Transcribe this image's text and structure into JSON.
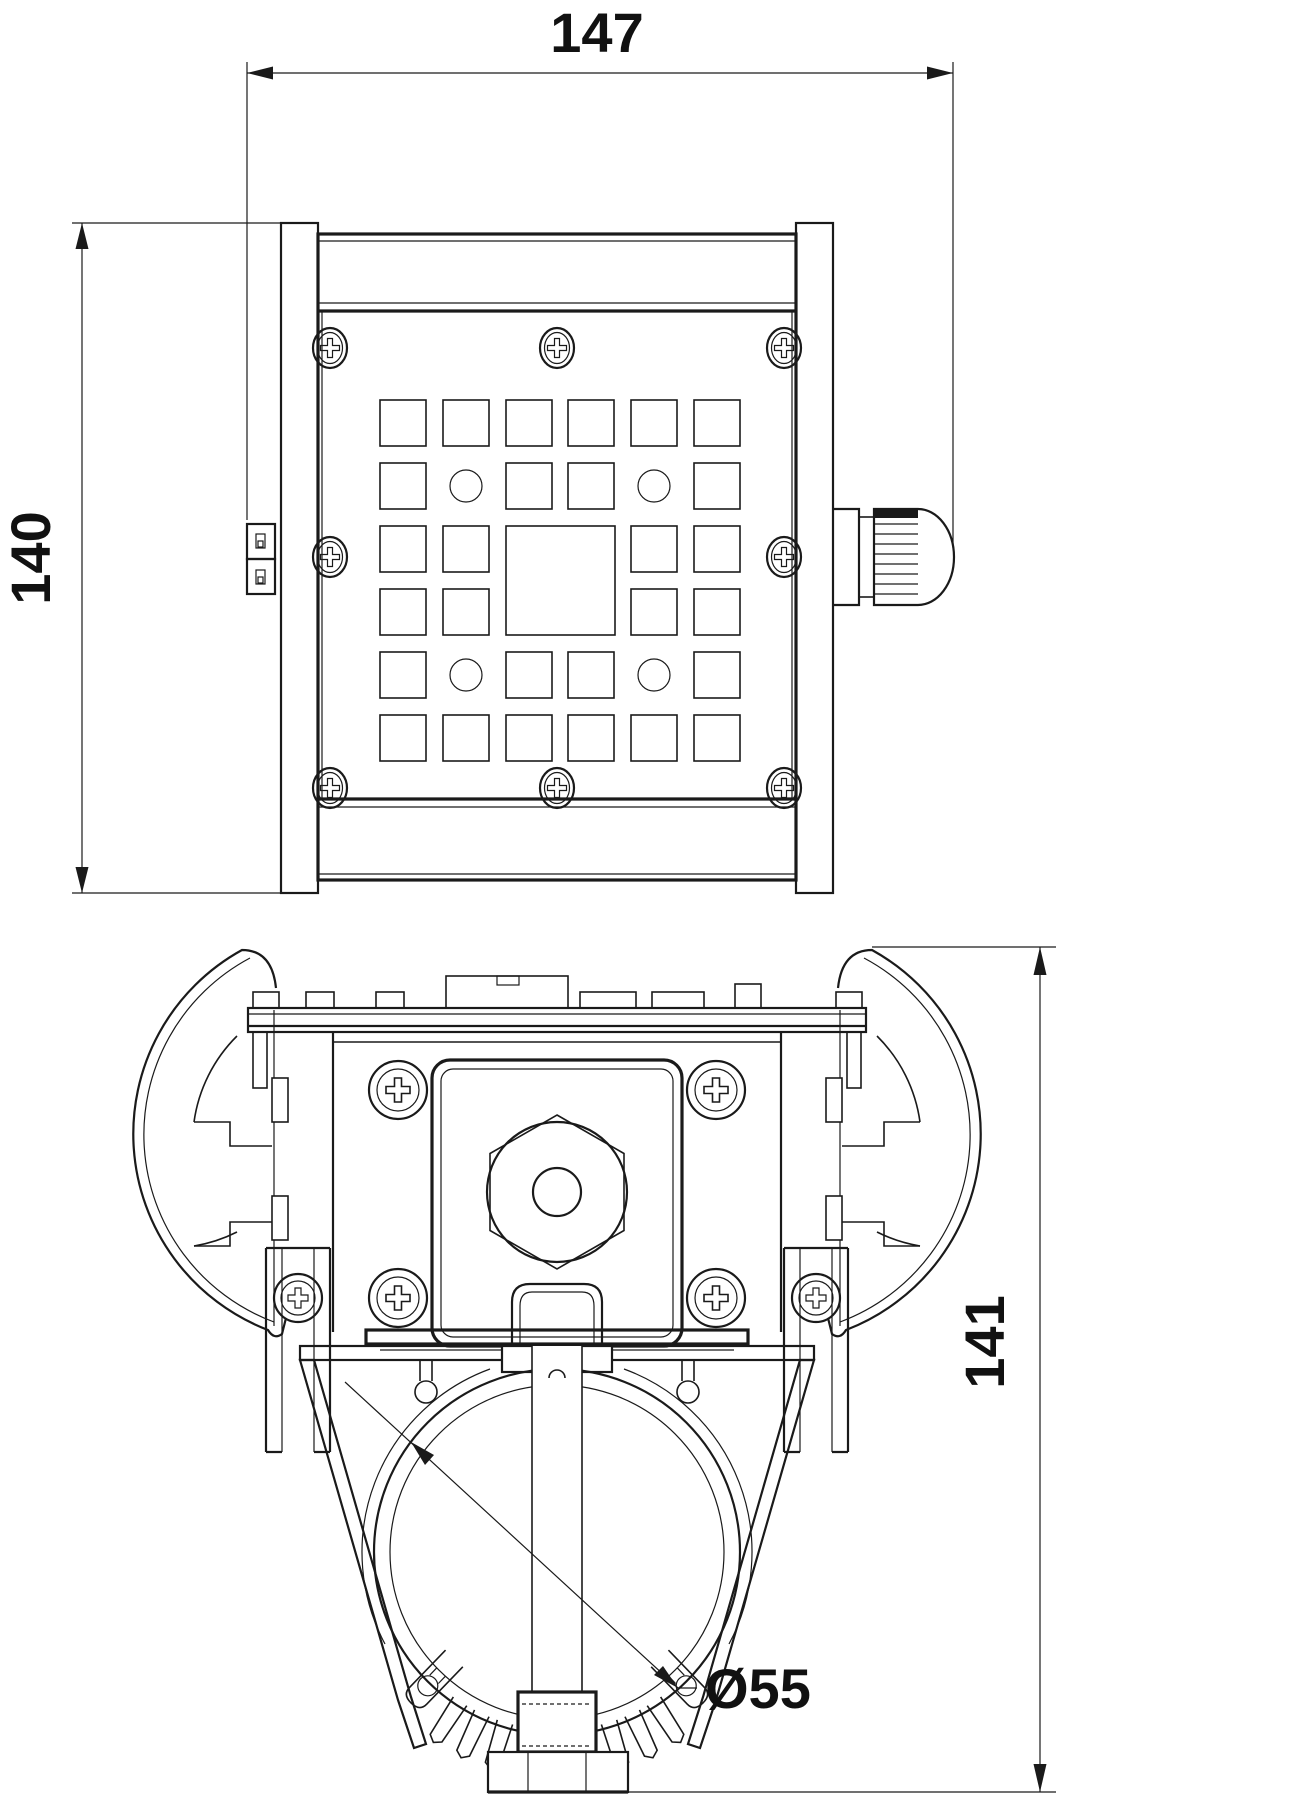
{
  "sheet": {
    "background_color": "#ffffff",
    "line_color": "#1a1a1a"
  },
  "views": {
    "front": {
      "width_label": "147",
      "height_label": "140"
    },
    "section": {
      "height_label": "141",
      "diameter_label": "Ø55"
    }
  }
}
